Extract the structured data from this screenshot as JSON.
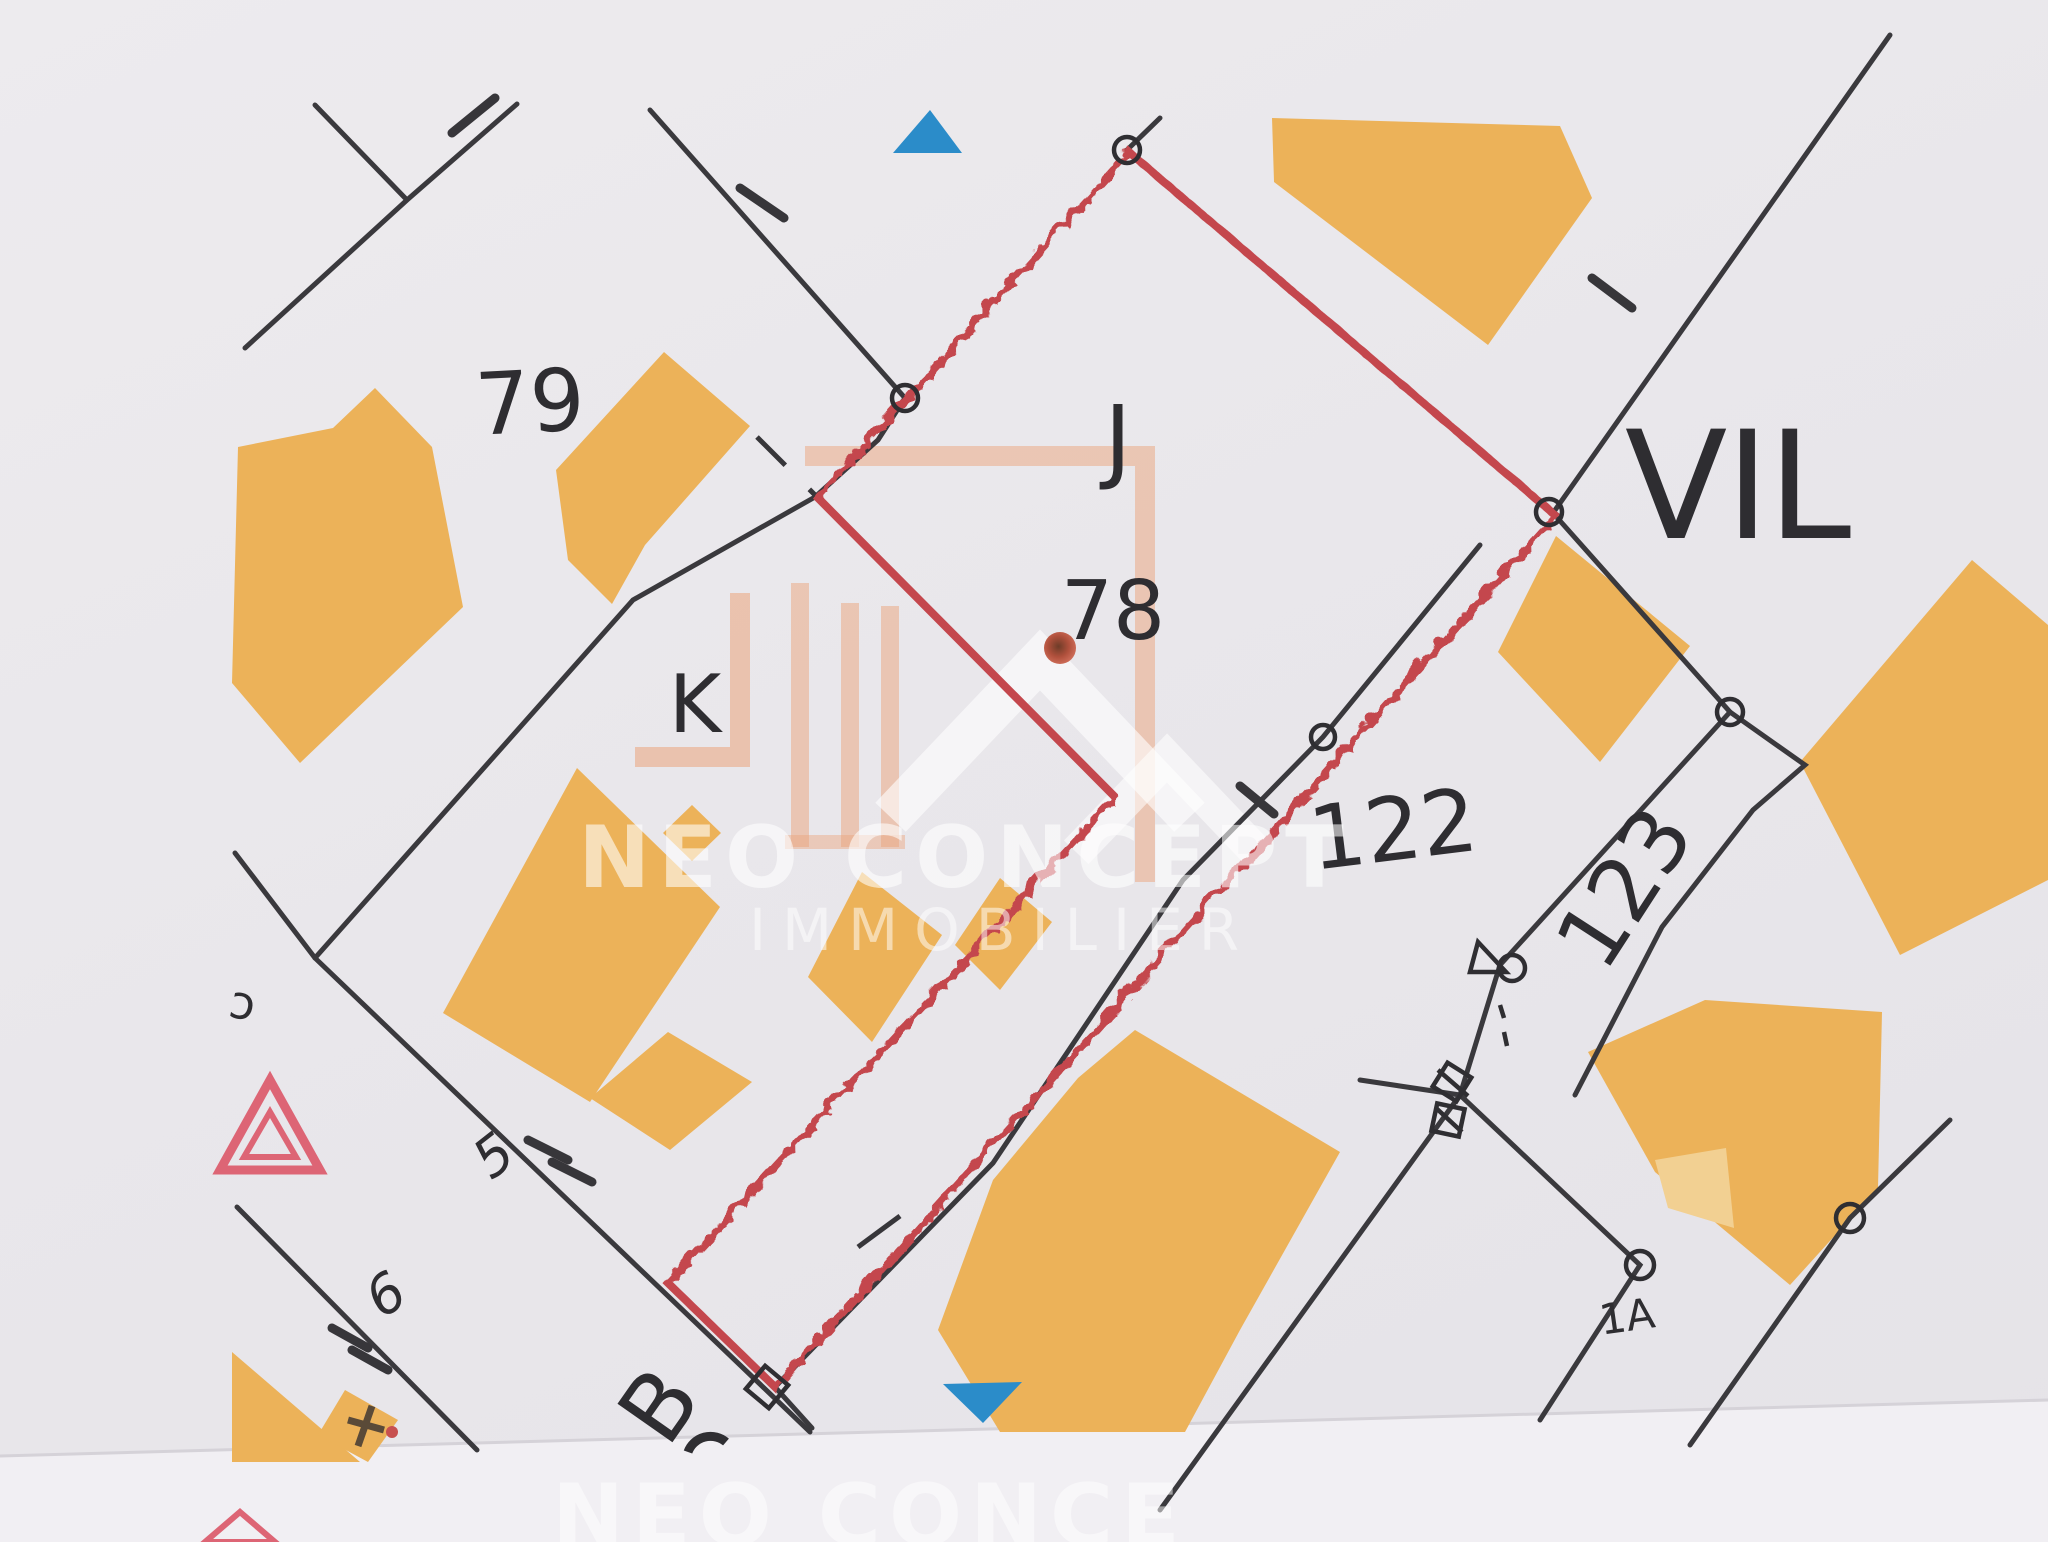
{
  "document": {
    "type": "cadastral-map-scan",
    "colors": {
      "paper": "#e9e7eb",
      "paper_bottom": "#f1eff3",
      "building_orange": "#ecb259",
      "building_light": "#f2d092",
      "boundary_red": "#c4474d",
      "line_black": "#3a393d",
      "blue_marker": "#2b8cc9",
      "pink_symbol": "#dd6575",
      "watermark_salmon": "#eba47c"
    }
  },
  "parcel_labels": {
    "p79": "79",
    "pJ": "J",
    "p78": "78",
    "pK": "K",
    "p122": "122",
    "p123": "123",
    "p1A": "1A",
    "road5": "5",
    "road6": "6",
    "edge_partial": "ɔ"
  },
  "street_labels": {
    "vil": "VIL",
    "b": "B"
  },
  "watermark": {
    "name": "NEO CONCEPT",
    "tagline": "IMMOBILIER",
    "partial_bottom": "NEO CONCE"
  }
}
